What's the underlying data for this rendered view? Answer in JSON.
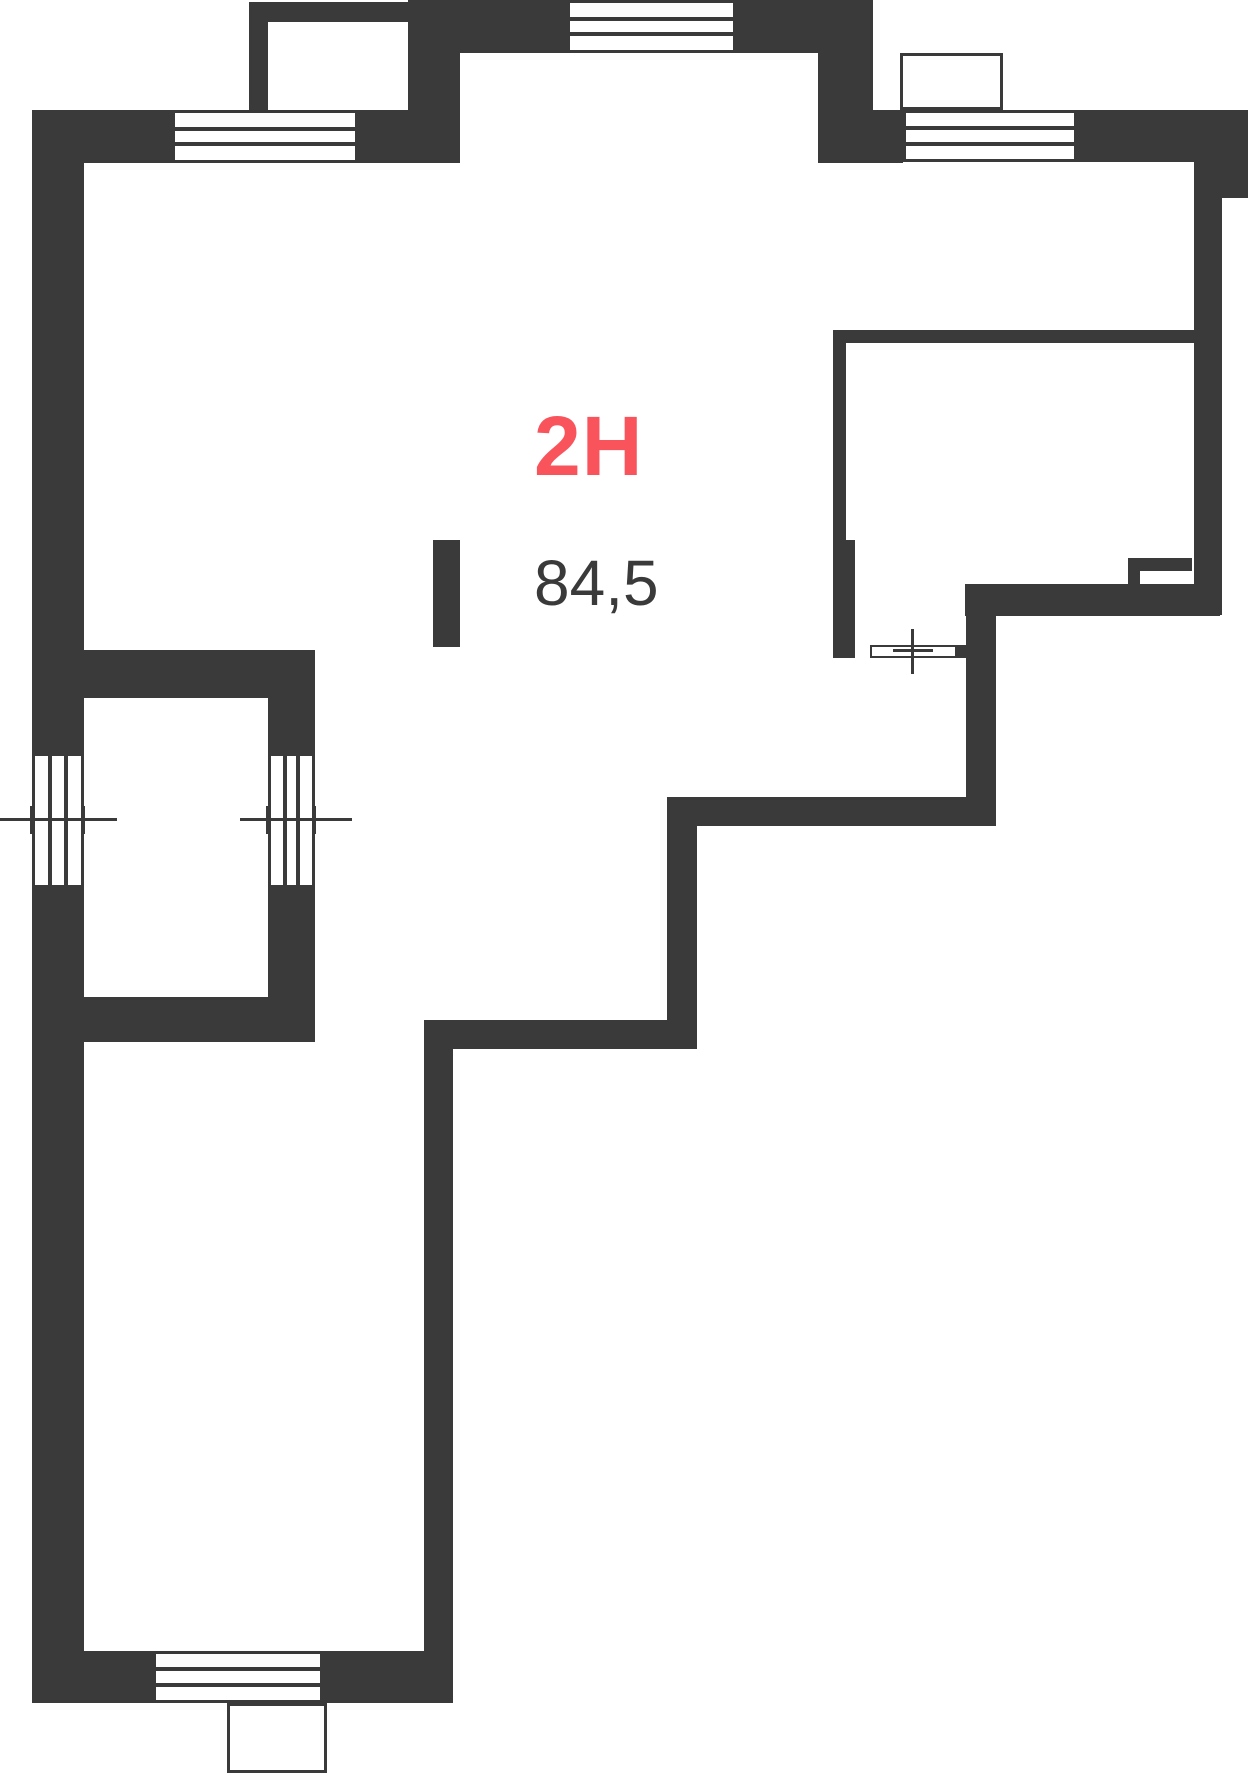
{
  "plan": {
    "unit_label": "2H",
    "area_label": "84,5",
    "colors": {
      "wall": "#3a3a3a",
      "accent": "#f9535c",
      "background": "#ffffff"
    },
    "canvas": {
      "width": 1248,
      "height": 1774
    },
    "walls": [
      {
        "name": "balcony-tl-left-wall",
        "x": 249,
        "y": 2,
        "w": 19,
        "h": 108
      },
      {
        "name": "balcony-tl-top-wall",
        "x": 249,
        "y": 2,
        "w": 159,
        "h": 20
      },
      {
        "name": "top-wall-west-segment",
        "x": 32,
        "y": 110,
        "w": 140,
        "h": 53
      },
      {
        "name": "top-wall-mid-segment",
        "x": 358,
        "y": 110,
        "w": 50,
        "h": 53
      },
      {
        "name": "top-wall-corner-block",
        "x": 408,
        "y": 0,
        "w": 52,
        "h": 163
      },
      {
        "name": "top-center-wall-left",
        "x": 460,
        "y": 0,
        "w": 107,
        "h": 53
      },
      {
        "name": "top-center-wall-right",
        "x": 736,
        "y": 0,
        "w": 137,
        "h": 53
      },
      {
        "name": "top-step-vertical-wall",
        "x": 818,
        "y": 53,
        "w": 55,
        "h": 110
      },
      {
        "name": "top-wall-east-left",
        "x": 873,
        "y": 110,
        "w": 30,
        "h": 53
      },
      {
        "name": "top-wall-east-right",
        "x": 1077,
        "y": 110,
        "w": 171,
        "h": 52
      },
      {
        "name": "ne-corner-step",
        "x": 1194,
        "y": 162,
        "w": 54,
        "h": 36
      },
      {
        "name": "east-wall",
        "x": 1194,
        "y": 198,
        "w": 28,
        "h": 417
      },
      {
        "name": "se-thick-wall",
        "x": 965,
        "y": 584,
        "w": 255,
        "h": 32
      },
      {
        "name": "mid-east-vertical-wall",
        "x": 966,
        "y": 585,
        "w": 30,
        "h": 241
      },
      {
        "name": "mid-horizontal-wall-upper",
        "x": 667,
        "y": 797,
        "w": 329,
        "h": 29
      },
      {
        "name": "mid-vertical-wall",
        "x": 667,
        "y": 797,
        "w": 30,
        "h": 252
      },
      {
        "name": "mid-horizontal-wall-lower",
        "x": 424,
        "y": 1020,
        "w": 273,
        "h": 29
      },
      {
        "name": "corridor-east-wall",
        "x": 424,
        "y": 1020,
        "w": 29,
        "h": 631
      },
      {
        "name": "bottom-wall-west",
        "x": 32,
        "y": 1651,
        "w": 121,
        "h": 52
      },
      {
        "name": "bottom-wall-east",
        "x": 323,
        "y": 1651,
        "w": 130,
        "h": 52
      },
      {
        "name": "west-wall-upper",
        "x": 32,
        "y": 110,
        "w": 52,
        "h": 643
      },
      {
        "name": "west-wall-lower",
        "x": 32,
        "y": 888,
        "w": 52,
        "h": 763
      },
      {
        "name": "left-room-top-wall",
        "x": 32,
        "y": 650,
        "w": 283,
        "h": 48
      },
      {
        "name": "left-room-east-wall-upper",
        "x": 268,
        "y": 650,
        "w": 47,
        "h": 103
      },
      {
        "name": "left-room-east-wall-lower",
        "x": 268,
        "y": 888,
        "w": 47,
        "h": 154
      },
      {
        "name": "left-room-bottom-wall",
        "x": 32,
        "y": 997,
        "w": 283,
        "h": 45
      },
      {
        "name": "shaft-stub-top",
        "x": 1128,
        "y": 558,
        "w": 64,
        "h": 13
      },
      {
        "name": "shaft-stub-leg",
        "x": 1128,
        "y": 558,
        "w": 12,
        "h": 26
      },
      {
        "name": "door-jamb",
        "x": 957,
        "y": 645,
        "w": 10,
        "h": 13
      },
      {
        "name": "interior-wall-stub",
        "x": 433,
        "y": 540,
        "w": 27,
        "h": 107
      },
      {
        "name": "room-top-wall",
        "x": 833,
        "y": 330,
        "w": 361,
        "h": 13
      },
      {
        "name": "room-west-wall-upper",
        "x": 833,
        "y": 330,
        "w": 13,
        "h": 210
      },
      {
        "name": "room-west-wall-lower",
        "x": 833,
        "y": 540,
        "w": 22,
        "h": 118
      }
    ],
    "windows": [
      {
        "name": "window-top-west",
        "x": 172,
        "y": 110,
        "w": 186,
        "h": 53,
        "orientation": "horizontal"
      },
      {
        "name": "window-top-center",
        "x": 567,
        "y": 0,
        "w": 169,
        "h": 53,
        "orientation": "horizontal"
      },
      {
        "name": "window-top-east",
        "x": 903,
        "y": 110,
        "w": 174,
        "h": 52,
        "orientation": "horizontal"
      },
      {
        "name": "window-west-outer",
        "x": 32,
        "y": 753,
        "w": 52,
        "h": 135,
        "orientation": "vertical"
      },
      {
        "name": "window-left-room",
        "x": 268,
        "y": 753,
        "w": 47,
        "h": 135,
        "orientation": "vertical"
      },
      {
        "name": "window-bottom",
        "x": 153,
        "y": 1651,
        "w": 170,
        "h": 52,
        "orientation": "horizontal"
      }
    ],
    "balconies": [
      {
        "name": "balcony-top-east",
        "x": 900,
        "y": 53,
        "w": 103,
        "h": 57
      },
      {
        "name": "balcony-bottom",
        "x": 227,
        "y": 1703,
        "w": 100,
        "h": 70
      }
    ],
    "door": {
      "name": "door-threshold",
      "x": 870,
      "y": 645,
      "w": 87,
      "h": 13
    },
    "markers": [
      {
        "name": "axis-window-west-line",
        "x": 0,
        "y": 818,
        "w": 117,
        "h": 3
      },
      {
        "name": "axis-window-west-tick-a",
        "x": 30,
        "y": 806,
        "w": 3,
        "h": 28
      },
      {
        "name": "axis-window-west-tick-b",
        "x": 82,
        "y": 806,
        "w": 3,
        "h": 28
      },
      {
        "name": "axis-left-room-line",
        "x": 240,
        "y": 818,
        "w": 112,
        "h": 3
      },
      {
        "name": "axis-left-room-tick-a",
        "x": 266,
        "y": 806,
        "w": 3,
        "h": 28
      },
      {
        "name": "axis-left-room-tick-b",
        "x": 313,
        "y": 806,
        "w": 3,
        "h": 28
      },
      {
        "name": "axis-door-line",
        "x": 911,
        "y": 629,
        "w": 3,
        "h": 45
      },
      {
        "name": "axis-door-tick",
        "x": 893,
        "y": 649,
        "w": 40,
        "h": 3
      }
    ]
  }
}
